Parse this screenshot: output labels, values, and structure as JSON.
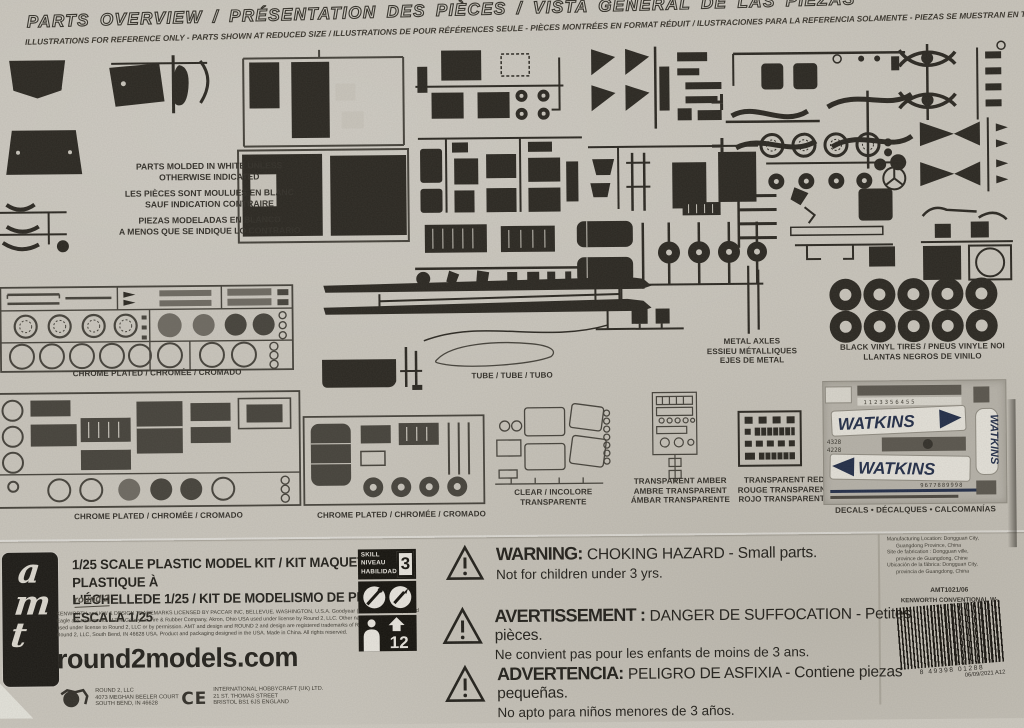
{
  "header": {
    "title": "PARTS OVERVIEW / PRÉSENTATION DES PIÈCES / VISTA GENERAL DE LAS PIEZAS",
    "subtitle": "ILLUSTRATIONS FOR REFERENCE ONLY - PARTS SHOWN AT REDUCED SIZE / ILLUSTRATIONS DE POUR RÉFÉRENCES SEULE - PIÈCES MONTRÉES EN FORMAT RÉDUIT / ILUSTRACIONES PARA LA REFERENCIA SOLAMENTE - PIEZAS SE MUESTRAN EN TAMAÑO REDUCIDO"
  },
  "molded_note": {
    "en1": "PARTS MOLDED IN WHITE UNLESS",
    "en2": "OTHERWISE INDICATED",
    "fr1": "LES PIÈCES SONT MOULUES EN BLANC",
    "fr2": "SAUF INDICATION  CONTRAIRE",
    "es1": "PIEZAS MODELADAS EN BLANCO",
    "es2": "A MENOS QUE SE INDIQUE LO CONTRARIO"
  },
  "labels": {
    "chrome": "CHROME PLATED / CHROMÉE / CROMADO",
    "tube": "TUBE / TUBE / TUBO",
    "metal_axles": [
      "METAL AXLES",
      "ESSIEU MÉTALLIQUES",
      "EJES DE METAL"
    ],
    "tires": [
      "BLACK VINYL TIRES / PNEUS VINYLE NOI",
      "LLANTAS NEGROS DE VINILO"
    ],
    "clear": [
      "CLEAR / INCOLORE",
      "TRANSPARENTE"
    ],
    "amber": [
      "TRANSPARENT AMBER",
      "AMBRE TRANSPARENT",
      "ÁMBAR TRANSPARENTE"
    ],
    "red": [
      "TRANSPARENT RED",
      "ROUGE TRANSPARENT",
      "ROJO TRANSPARENTE"
    ],
    "decals": "DECALS • DÉCALQUES • CALCOMANÍAS"
  },
  "decals": {
    "brand": "WATKINS",
    "num1": "1123356455",
    "num2": "4328",
    "num3": "4228",
    "num4": "9677889998"
  },
  "footer": {
    "brand": "amt",
    "scale1": "1/25 SCALE PLASTIC MODEL KIT / KIT MAQUETTE EN PLASTIQUE À",
    "scale2": "L'ÉCHELLEDE 1/25 / KIT DE MODELISMO DE PLÁSTICO ESCALA 1/25",
    "round2_script": "round 2",
    "legal": [
      "KENWORTH and KW & DESIGN TRADEMARKS LICENSED BY PACCAR INC, BELLEVUE, WASHINGTON, U.S.A. Goodyear (and wing foot design) and",
      "Eagle are trademarks of The Goodyear Tire & Rubber Company, Akron, Ohio USA used under license by Round 2, LLC. Other names and trademarks",
      "used under license to Round 2, LLC or by permission. AMT and design and ROUND 2 and design are registered trademarks of Round 2, LLC. ©2017",
      "Round 2, LLC, South Bend, IN 46628 USA.  Product and packaging designed in the USA. Made in China.  All rights reserved."
    ],
    "website": "round2models.com",
    "round2_name": "ROUND 2, LLC",
    "round2_addr1": "4073 MEGHAN BEELER COURT",
    "round2_addr2": "SOUTH BEND, IN 46628",
    "ce": "CE",
    "ihc_name": "INTERNATIONAL HOBBYCRAFT (UK) LTD.",
    "ihc_addr1": "21 ST. THOMAS STREET",
    "ihc_addr2": "BRISTOL BS1 6JS ENGLAND",
    "skill": {
      "en": "SKILL",
      "fr": "NIVEAU",
      "es": "HABILIDAD",
      "level": "3",
      "age": "12"
    },
    "warnings": [
      {
        "title": "WARNING:",
        "text": "CHOKING HAZARD - Small parts.",
        "sub": "Not for children under 3 yrs."
      },
      {
        "title": "AVERTISSEMENT :",
        "text": "DANGER DE SUFFOCATION - Petites pièces.",
        "sub": "Ne convient pas pour les enfants de moins de 3 ans."
      },
      {
        "title": "ADVERTENCIA:",
        "text": "PELIGRO DE ASFIXIA - Contiene piezas pequeñas.",
        "sub": "No apto para niños menores de 3 años."
      }
    ],
    "mfg": [
      "Manufacturing Location:  Dongguan City,",
      "Guangdong Province, China",
      "Site de fabrication :  Dongguan ville,",
      "province de Guangdong, Chine",
      "Ubicación de la fábrica:  Dongguan City,",
      "provincia de Guangdong, China"
    ],
    "sku": "AMT1021/06",
    "product": "KENWORTH CONVENTIONAL W-",
    "barcode": "8  49398 01288",
    "date_code": "06/09/2021 A12"
  }
}
